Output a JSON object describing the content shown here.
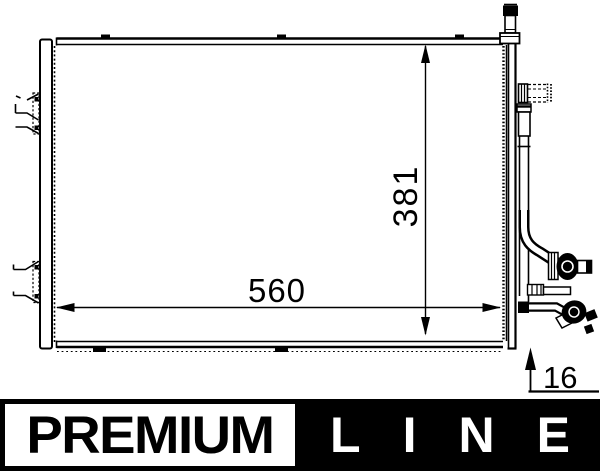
{
  "drawing": {
    "dim_height": "381",
    "dim_width": "560",
    "dim_depth": "16"
  },
  "logo": {
    "premium": "PREMIUM",
    "line": "LINE"
  },
  "colors": {
    "ink": "#000000",
    "background": "#ffffff",
    "logo_black": "#000000",
    "logo_text_light": "#ffffff"
  }
}
